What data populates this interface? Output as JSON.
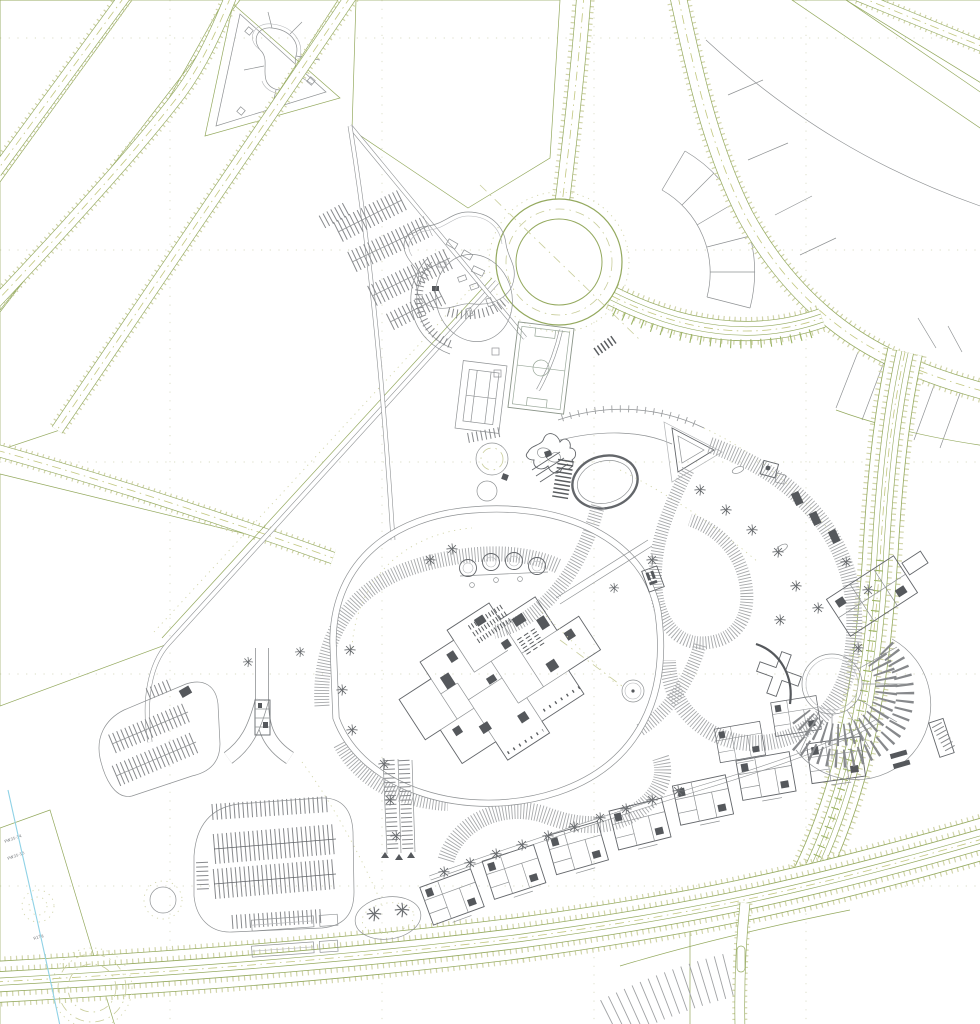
{
  "colors": {
    "background": "#ffffff",
    "line_gray": "#8f9294",
    "line_gray_dark": "#63666a",
    "line_gray_light": "#b6b8bb",
    "dark_fill": "#55585c",
    "road_green": "#94a95e",
    "road_khaki": "#c9cd9b",
    "road_center": "#c2c77f",
    "road_dot": "#d2d5ab",
    "grid_dot": "#dadcc6",
    "hatch_gray": "#a7a9ab",
    "water_cyan": "#8fd2e6"
  },
  "plot_labels": [
    {
      "text": "PW35-14"
    },
    {
      "text": "PW35-15"
    },
    {
      "text": "R17g"
    }
  ]
}
